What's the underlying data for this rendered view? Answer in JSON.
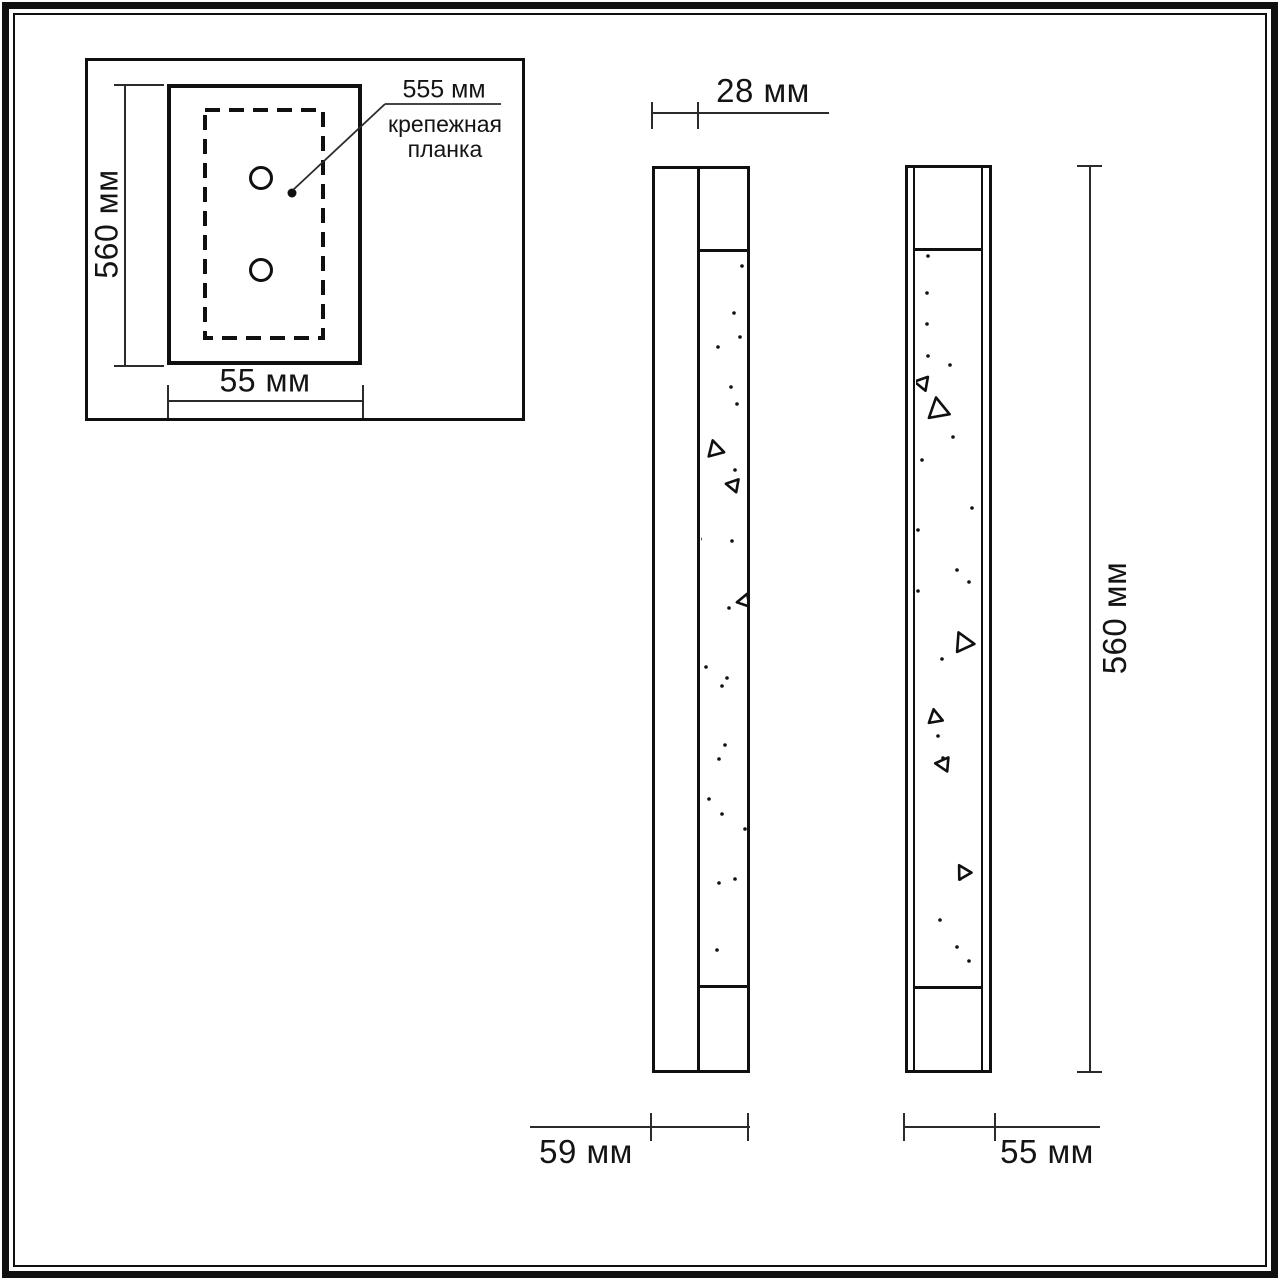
{
  "drawing": {
    "colors": {
      "line": "#101010",
      "dim_line": "#2b2b2b",
      "background": "#ffffff"
    },
    "inset": {
      "height": "560 мм",
      "width": "55 мм",
      "bracket_length": "555 мм",
      "bracket_name_line1": "крепежная",
      "bracket_name_line2": "планка"
    },
    "side_view": {
      "depth_top": "28 мм",
      "depth_bottom": "59 мм"
    },
    "front_view": {
      "height": "560 мм",
      "width": "55 мм"
    }
  },
  "sparkles": {
    "side": {
      "dots": [
        [
          742,
          266
        ],
        [
          734,
          313
        ],
        [
          740,
          337
        ],
        [
          718,
          347
        ],
        [
          731,
          387
        ],
        [
          737,
          404
        ],
        [
          735,
          470
        ],
        [
          700,
          539
        ],
        [
          732,
          541
        ],
        [
          729,
          608
        ],
        [
          706,
          667
        ],
        [
          727,
          678
        ],
        [
          722,
          686
        ],
        [
          725,
          745
        ],
        [
          719,
          759
        ],
        [
          709,
          799
        ],
        [
          722,
          814
        ],
        [
          745,
          829
        ],
        [
          735,
          879
        ],
        [
          719,
          883
        ],
        [
          717,
          950
        ]
      ],
      "triangles": [
        {
          "x": 715,
          "y": 449,
          "s": 16,
          "r": -15
        },
        {
          "x": 733,
          "y": 485,
          "s": 13,
          "r": -80
        },
        {
          "x": 744,
          "y": 601,
          "s": 13,
          "r": -100
        }
      ]
    },
    "front": {
      "dots": [
        [
          928,
          256
        ],
        [
          927,
          293
        ],
        [
          927,
          324
        ],
        [
          928,
          356
        ],
        [
          950,
          365
        ],
        [
          953,
          437
        ],
        [
          922,
          460
        ],
        [
          972,
          508
        ],
        [
          918,
          530
        ],
        [
          957,
          570
        ],
        [
          969,
          582
        ],
        [
          918,
          591
        ],
        [
          942,
          659
        ],
        [
          938,
          736
        ],
        [
          943,
          758
        ],
        [
          960,
          879
        ],
        [
          940,
          920
        ],
        [
          957,
          947
        ],
        [
          969,
          961
        ]
      ],
      "triangles": [
        {
          "x": 922,
          "y": 383,
          "s": 14,
          "r": -80
        },
        {
          "x": 938,
          "y": 409,
          "s": 21,
          "r": -10
        },
        {
          "x": 963,
          "y": 642,
          "s": 19,
          "r": -25
        },
        {
          "x": 935,
          "y": 717,
          "s": 14,
          "r": -10
        },
        {
          "x": 943,
          "y": 764,
          "s": 14,
          "r": -85
        },
        {
          "x": 963,
          "y": 872,
          "s": 14,
          "r": -30
        }
      ]
    }
  }
}
